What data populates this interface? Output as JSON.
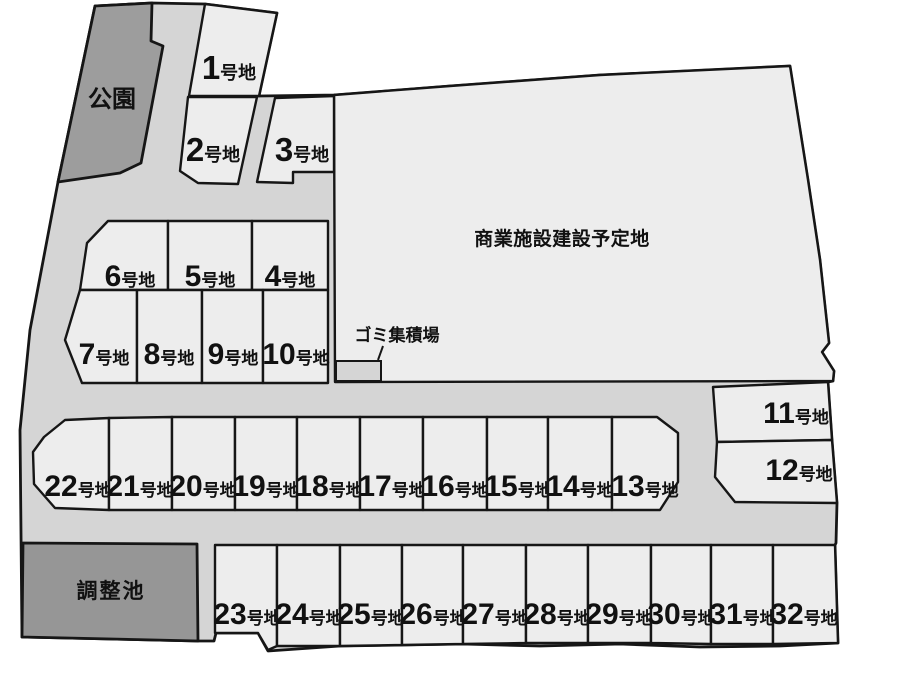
{
  "map": {
    "areas": {
      "park": "公園",
      "commercial": "商業施設建設予定地",
      "garbage_station": "ゴミ集積場",
      "retention_pond": "調整池"
    },
    "lot_suffix": "号地",
    "lots": [
      {
        "number": "1"
      },
      {
        "number": "2"
      },
      {
        "number": "3"
      },
      {
        "number": "4"
      },
      {
        "number": "5"
      },
      {
        "number": "6"
      },
      {
        "number": "7"
      },
      {
        "number": "8"
      },
      {
        "number": "9"
      },
      {
        "number": "10"
      },
      {
        "number": "11"
      },
      {
        "number": "12"
      },
      {
        "number": "13"
      },
      {
        "number": "14"
      },
      {
        "number": "15"
      },
      {
        "number": "16"
      },
      {
        "number": "17"
      },
      {
        "number": "18"
      },
      {
        "number": "19"
      },
      {
        "number": "20"
      },
      {
        "number": "21"
      },
      {
        "number": "22"
      },
      {
        "number": "23"
      },
      {
        "number": "24"
      },
      {
        "number": "25"
      },
      {
        "number": "26"
      },
      {
        "number": "27"
      },
      {
        "number": "28"
      },
      {
        "number": "29"
      },
      {
        "number": "30"
      },
      {
        "number": "31"
      },
      {
        "number": "32"
      }
    ]
  },
  "colors": {
    "road": "#d5d5d5",
    "lot": "#ededed",
    "park": "#9d9d9d",
    "pond": "#969696",
    "outline": "#161616",
    "text": "#111111"
  }
}
